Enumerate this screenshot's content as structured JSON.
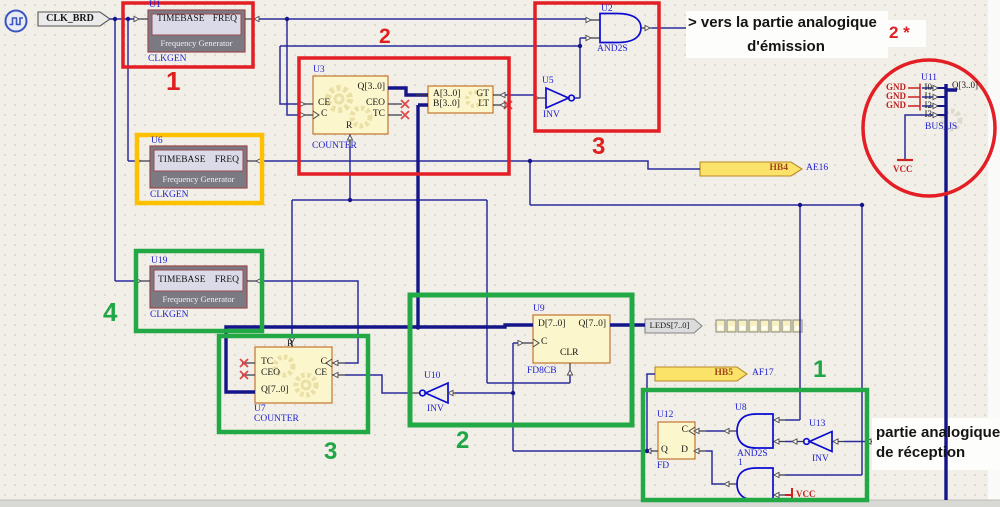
{
  "icons": {
    "clock_source": "clock-waveform-icon"
  },
  "ports": {
    "clk_brd": "CLK_BRD",
    "hb4": "HB4",
    "hb4_pin": "AE16",
    "hb5": "HB5",
    "hb5_pin": "AF17",
    "leds": "LEDS[7..0]"
  },
  "power": {
    "gnd1": "GND",
    "gnd2": "GND",
    "gnd3": "GND",
    "vcc_bus": "VCC",
    "vcc_gate": "VCC"
  },
  "components": {
    "u1": {
      "ref": "U1",
      "lib": "CLKGEN",
      "pin_in": "TIMEBASE",
      "pin_out": "FREQ",
      "title": "Frequency Generator"
    },
    "u6": {
      "ref": "U6",
      "lib": "CLKGEN",
      "pin_in": "TIMEBASE",
      "pin_out": "FREQ",
      "title": "Frequency Generator"
    },
    "u19": {
      "ref": "U19",
      "lib": "CLKGEN",
      "pin_in": "TIMEBASE",
      "pin_out": "FREQ",
      "title": "Frequency Generator"
    },
    "u3": {
      "ref": "U3",
      "lib": "COUNTER",
      "pins": {
        "ce": "CE",
        "c": "C",
        "q": "Q[3..0]",
        "ceo": "CEO",
        "tc": "TC",
        "r": "R"
      }
    },
    "cmp": {
      "pins": {
        "a": "A[3..0]",
        "b": "B[3..0]",
        "gt": "GT",
        "lt": "LT"
      }
    },
    "u2": {
      "ref": "U2",
      "lib": "AND2S"
    },
    "u5": {
      "ref": "U5",
      "lib": "INV"
    },
    "u7": {
      "ref": "U7",
      "lib": "COUNTER",
      "pins": {
        "tc": "TC",
        "ceo": "CEO",
        "q": "Q[7..0]",
        "c": "C",
        "ce": "CE",
        "r": "R"
      }
    },
    "u9": {
      "ref": "U9",
      "lib": "FD8CB",
      "pins": {
        "d": "D[7..0]",
        "c": "C",
        "q": "Q[7..0]",
        "clr": "CLR"
      }
    },
    "u10": {
      "ref": "U10",
      "lib": "INV"
    },
    "u11": {
      "ref": "U11",
      "lib": "BUS_JS",
      "pins": {
        "i0": "I0",
        "i1": "I1",
        "i2": "I2",
        "i3": "I3",
        "q": "Q[3..0]"
      }
    },
    "u12": {
      "ref": "U12",
      "lib": "FD",
      "pins": {
        "c": "C",
        "d": "D",
        "q": "Q"
      }
    },
    "u8": {
      "ref": "U8",
      "lib": "AND2S"
    },
    "u13": {
      "ref": "U13",
      "lib": "INV"
    },
    "gate1": {
      "ref": "1"
    }
  },
  "annotations": {
    "emission": {
      "line1": "> vers la partie analogique",
      "line2": "d'émission"
    },
    "reception": {
      "line1": "partie analogique",
      "line2": "de réception"
    },
    "markers": {
      "red_1": "1",
      "red_2": "2",
      "red_3": "3",
      "red_2star": "2 *",
      "green_1": "1",
      "green_2": "2",
      "green_3": "3",
      "green_4": "4"
    }
  },
  "colors": {
    "red": "#e31e24",
    "orange": "#ffc000",
    "green": "#1fa646",
    "wire": "#2b2b9e",
    "bus": "#15158a",
    "gate": "#0a0ad2"
  }
}
